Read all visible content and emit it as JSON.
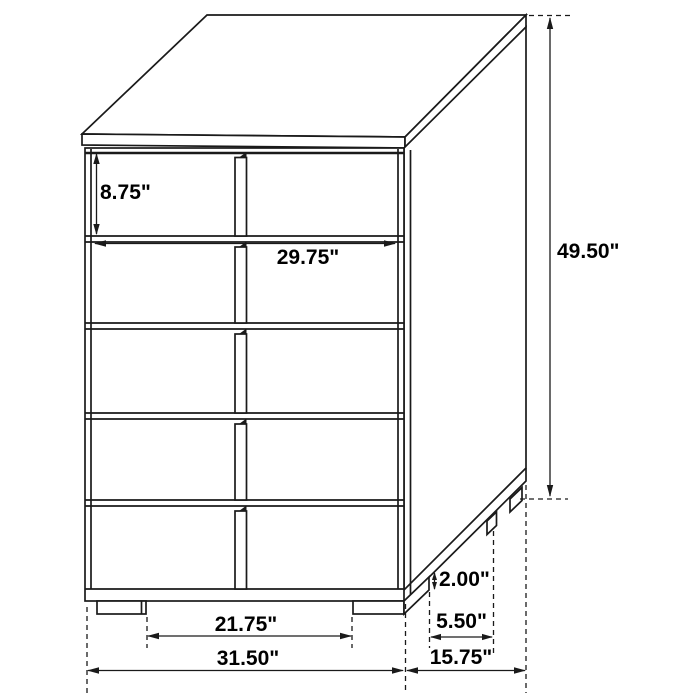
{
  "figure": {
    "description": "Line drawing of a five-drawer chest shown in perspective with dimension callouts",
    "unit": "inches",
    "drawer_rows": 5,
    "drawer_fronts_per_row": 2
  },
  "dims": {
    "top_drawer_height": "8.75\"",
    "drawer_width": "29.75\"",
    "overall_height": "49.50\"",
    "foot_height": "2.00\"",
    "side_foot_spacing": "5.50\"",
    "depth": "15.75\"",
    "front_foot_spacing": "21.75\"",
    "width": "31.50\""
  },
  "colors": {
    "line": "#1a1a1a",
    "text": "#000000",
    "background": "#ffffff"
  }
}
